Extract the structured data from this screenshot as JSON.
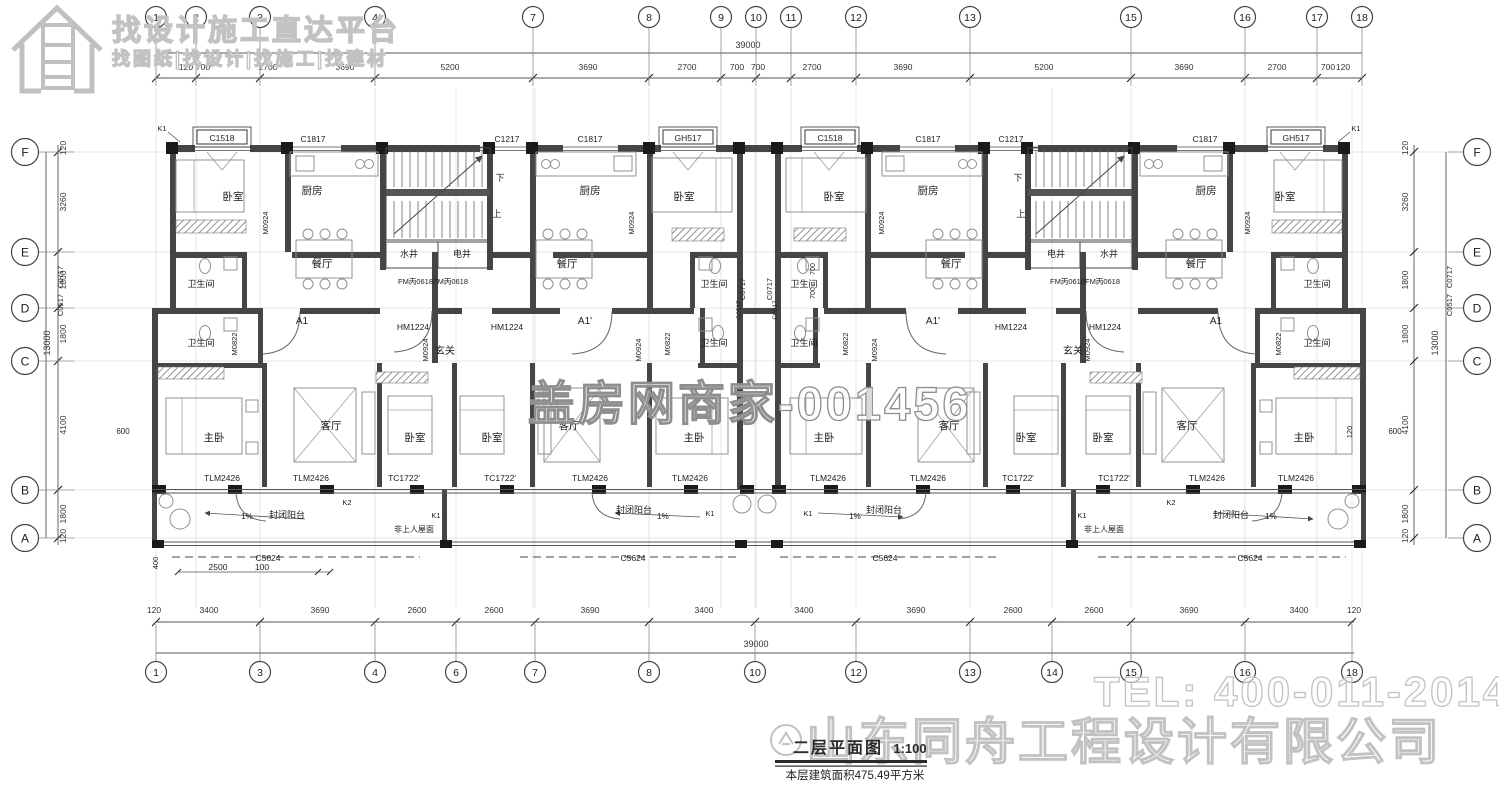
{
  "watermarks": {
    "banner_line1": "找设计施工直达平台",
    "banner_line2": "找图纸|找设计|找施工|找建材",
    "center": "盖房网商家-001456",
    "tel": "TEL: 400-011-2014",
    "company": "山东同舟工程设计有限公司"
  },
  "title_block": {
    "title": "二层平面图",
    "scale": "1:100",
    "area_note": "本层建筑面积475.49平方米"
  },
  "colors": {
    "wall": "#454545",
    "pier": "#1a1a1a",
    "dim_text": "#333333",
    "watermark": "#c2c2c2",
    "accent_line": "#555555"
  },
  "grid": {
    "total_width_label": "39000",
    "total_height_label": "13000",
    "top_bubbles": [
      {
        "label": "1",
        "x": 156
      },
      {
        "label": "2",
        "x": 196
      },
      {
        "label": "3",
        "x": 260
      },
      {
        "label": "4",
        "x": 375
      },
      {
        "label": "7",
        "x": 533
      },
      {
        "label": "8",
        "x": 649
      },
      {
        "label": "9",
        "x": 721
      },
      {
        "label": "10",
        "x": 756
      },
      {
        "label": "11",
        "x": 791
      },
      {
        "label": "12",
        "x": 856
      },
      {
        "label": "13",
        "x": 970
      },
      {
        "label": "15",
        "x": 1131
      },
      {
        "label": "16",
        "x": 1245
      },
      {
        "label": "17",
        "x": 1317
      },
      {
        "label": "18",
        "x": 1362
      }
    ],
    "bottom_bubbles": [
      {
        "label": "1",
        "x": 156
      },
      {
        "label": "3",
        "x": 260
      },
      {
        "label": "4",
        "x": 375
      },
      {
        "label": "6",
        "x": 456
      },
      {
        "label": "7",
        "x": 535
      },
      {
        "label": "8",
        "x": 649
      },
      {
        "label": "10",
        "x": 755
      },
      {
        "label": "12",
        "x": 856
      },
      {
        "label": "13",
        "x": 970
      },
      {
        "label": "14",
        "x": 1052
      },
      {
        "label": "15",
        "x": 1131
      },
      {
        "label": "16",
        "x": 1245
      },
      {
        "label": "18",
        "x": 1352
      }
    ],
    "left_bubbles": [
      {
        "label": "F",
        "y": 152
      },
      {
        "label": "E",
        "y": 252
      },
      {
        "label": "D",
        "y": 308
      },
      {
        "label": "C",
        "y": 361
      },
      {
        "label": "B",
        "y": 490
      },
      {
        "label": "A",
        "y": 538
      }
    ],
    "right_bubbles": [
      {
        "label": "F",
        "y": 152
      },
      {
        "label": "E",
        "y": 252
      },
      {
        "label": "D",
        "y": 308
      },
      {
        "label": "C",
        "y": 361
      },
      {
        "label": "B",
        "y": 490
      },
      {
        "label": "A",
        "y": 538
      }
    ],
    "top_dims": [
      {
        "t": "120",
        "x": 186
      },
      {
        "t": "700",
        "x": 203
      },
      {
        "t": "2700",
        "x": 268
      },
      {
        "t": "3690",
        "x": 345
      },
      {
        "t": "5200",
        "x": 450
      },
      {
        "t": "3690",
        "x": 588
      },
      {
        "t": "2700",
        "x": 687
      },
      {
        "t": "700",
        "x": 737
      },
      {
        "t": "700",
        "x": 758
      },
      {
        "t": "2700",
        "x": 812
      },
      {
        "t": "3690",
        "x": 903
      },
      {
        "t": "5200",
        "x": 1044
      },
      {
        "t": "3690",
        "x": 1184
      },
      {
        "t": "2700",
        "x": 1277
      },
      {
        "t": "700",
        "x": 1328
      },
      {
        "t": "120",
        "x": 1343
      }
    ],
    "bottom_dims": [
      {
        "t": "120",
        "x": 154
      },
      {
        "t": "3400",
        "x": 209
      },
      {
        "t": "3690",
        "x": 320
      },
      {
        "t": "2600",
        "x": 417
      },
      {
        "t": "2600",
        "x": 494
      },
      {
        "t": "3690",
        "x": 590
      },
      {
        "t": "3400",
        "x": 704
      },
      {
        "t": "3400",
        "x": 804
      },
      {
        "t": "3690",
        "x": 916
      },
      {
        "t": "2600",
        "x": 1013
      },
      {
        "t": "2600",
        "x": 1094
      },
      {
        "t": "3690",
        "x": 1189
      },
      {
        "t": "3400",
        "x": 1299
      },
      {
        "t": "120",
        "x": 1354
      }
    ],
    "left_dims": [
      {
        "t": "120",
        "y": 148
      },
      {
        "t": "3260",
        "y": 202
      },
      {
        "t": "1800",
        "y": 280
      },
      {
        "t": "1800",
        "y": 334
      },
      {
        "t": "4100",
        "y": 425
      },
      {
        "t": "1800",
        "y": 514
      },
      {
        "t": "120",
        "y": 536
      }
    ],
    "right_dims": [
      {
        "t": "120",
        "y": 148
      },
      {
        "t": "3260",
        "y": 202
      },
      {
        "t": "1800",
        "y": 280
      },
      {
        "t": "1800",
        "y": 334
      },
      {
        "t": "4100",
        "y": 425
      },
      {
        "t": "1800",
        "y": 514
      },
      {
        "t": "120",
        "y": 536
      }
    ]
  },
  "plan_labels": {
    "rooms": [
      {
        "t": "卧室",
        "x": 233,
        "y": 200
      },
      {
        "t": "厨房",
        "x": 312,
        "y": 194
      },
      {
        "t": "厨房",
        "x": 590,
        "y": 194
      },
      {
        "t": "卧室",
        "x": 684,
        "y": 200
      },
      {
        "t": "卧室",
        "x": 834,
        "y": 200
      },
      {
        "t": "厨房",
        "x": 928,
        "y": 194
      },
      {
        "t": "厨房",
        "x": 1206,
        "y": 194
      },
      {
        "t": "卧室",
        "x": 1285,
        "y": 200
      },
      {
        "t": "餐厅",
        "x": 322,
        "y": 267
      },
      {
        "t": "餐厅",
        "x": 567,
        "y": 267
      },
      {
        "t": "餐厅",
        "x": 951,
        "y": 267
      },
      {
        "t": "餐厅",
        "x": 1196,
        "y": 267
      },
      {
        "t": "水井",
        "x": 409,
        "y": 257,
        "s": 9
      },
      {
        "t": "电井",
        "x": 462,
        "y": 257,
        "s": 9
      },
      {
        "t": "电井",
        "x": 1056,
        "y": 257,
        "s": 9
      },
      {
        "t": "水井",
        "x": 1109,
        "y": 257,
        "s": 9
      },
      {
        "t": "卫生间",
        "x": 201,
        "y": 287,
        "s": 9
      },
      {
        "t": "卫生间",
        "x": 714,
        "y": 287,
        "s": 9
      },
      {
        "t": "卫生间",
        "x": 804,
        "y": 287,
        "s": 9
      },
      {
        "t": "卫生间",
        "x": 1317,
        "y": 287,
        "s": 9
      },
      {
        "t": "卫生间",
        "x": 201,
        "y": 346,
        "s": 9
      },
      {
        "t": "卫生间",
        "x": 714,
        "y": 346,
        "s": 9
      },
      {
        "t": "卫生间",
        "x": 804,
        "y": 346,
        "s": 9
      },
      {
        "t": "卫生间",
        "x": 1317,
        "y": 346,
        "s": 9
      },
      {
        "t": "玄关",
        "x": 445,
        "y": 354,
        "s": 10
      },
      {
        "t": "玄关",
        "x": 1073,
        "y": 354,
        "s": 10
      },
      {
        "t": "下",
        "x": 500,
        "y": 181,
        "s": 9
      },
      {
        "t": "上",
        "x": 497,
        "y": 217,
        "s": 9
      },
      {
        "t": "下",
        "x": 1018,
        "y": 181,
        "s": 9
      },
      {
        "t": "上",
        "x": 1021,
        "y": 217,
        "s": 9
      },
      {
        "t": "A1",
        "x": 302,
        "y": 324,
        "s": 10
      },
      {
        "t": "A1'",
        "x": 585,
        "y": 324,
        "s": 10
      },
      {
        "t": "A1'",
        "x": 933,
        "y": 324,
        "s": 10
      },
      {
        "t": "A1",
        "x": 1216,
        "y": 324,
        "s": 10
      },
      {
        "t": "主卧",
        "x": 214,
        "y": 441
      },
      {
        "t": "客厅",
        "x": 331,
        "y": 429
      },
      {
        "t": "卧室",
        "x": 415,
        "y": 441
      },
      {
        "t": "卧室",
        "x": 492,
        "y": 441
      },
      {
        "t": "客厅",
        "x": 569,
        "y": 429
      },
      {
        "t": "主卧",
        "x": 694,
        "y": 441
      },
      {
        "t": "主卧",
        "x": 824,
        "y": 441
      },
      {
        "t": "客厅",
        "x": 949,
        "y": 429
      },
      {
        "t": "卧室",
        "x": 1026,
        "y": 441
      },
      {
        "t": "卧室",
        "x": 1103,
        "y": 441
      },
      {
        "t": "客厅",
        "x": 1187,
        "y": 429
      },
      {
        "t": "主卧",
        "x": 1304,
        "y": 441
      },
      {
        "t": "封闭阳台",
        "x": 287,
        "y": 518,
        "s": 9
      },
      {
        "t": "封闭阳台",
        "x": 634,
        "y": 513,
        "s": 9
      },
      {
        "t": "封闭阳台",
        "x": 884,
        "y": 513,
        "s": 9
      },
      {
        "t": "封闭阳台",
        "x": 1231,
        "y": 518,
        "s": 9
      },
      {
        "t": "非上人屋面",
        "x": 414,
        "y": 532,
        "s": 8
      },
      {
        "t": "非上人屋面",
        "x": 1104,
        "y": 532,
        "s": 8
      }
    ],
    "tags": [
      {
        "t": "C1518",
        "x": 222,
        "y": 139,
        "box": true
      },
      {
        "t": "GH517",
        "x": 688,
        "y": 139,
        "box": true
      },
      {
        "t": "C1518",
        "x": 830,
        "y": 139,
        "box": true
      },
      {
        "t": "GH517",
        "x": 1296,
        "y": 139,
        "box": true
      },
      {
        "t": "C1817",
        "x": 313,
        "y": 140
      },
      {
        "t": "C1217",
        "x": 507,
        "y": 140
      },
      {
        "t": "C1817",
        "x": 590,
        "y": 140
      },
      {
        "t": "C1817",
        "x": 928,
        "y": 140
      },
      {
        "t": "C1217",
        "x": 1011,
        "y": 140
      },
      {
        "t": "C1817",
        "x": 1205,
        "y": 140
      },
      {
        "t": "FM丙0618FM丙0618",
        "x": 433,
        "y": 282,
        "s": 7.5
      },
      {
        "t": "FM丙0618FM丙0618",
        "x": 1085,
        "y": 282,
        "s": 7.5
      },
      {
        "t": "HM1224",
        "x": 413,
        "y": 328
      },
      {
        "t": "HM1224",
        "x": 507,
        "y": 328
      },
      {
        "t": "HM1224",
        "x": 1011,
        "y": 328
      },
      {
        "t": "HM1224",
        "x": 1105,
        "y": 328
      },
      {
        "t": "TLM2426",
        "x": 222,
        "y": 479
      },
      {
        "t": "TLM2426",
        "x": 311,
        "y": 479
      },
      {
        "t": "TC1722'",
        "x": 404,
        "y": 479
      },
      {
        "t": "TC1722'",
        "x": 500,
        "y": 479
      },
      {
        "t": "TLM2426",
        "x": 590,
        "y": 479
      },
      {
        "t": "TLM2426",
        "x": 690,
        "y": 479
      },
      {
        "t": "TLM2426",
        "x": 828,
        "y": 479
      },
      {
        "t": "TLM2426",
        "x": 928,
        "y": 479
      },
      {
        "t": "TC1722'",
        "x": 1018,
        "y": 479
      },
      {
        "t": "TC1722'",
        "x": 1114,
        "y": 479
      },
      {
        "t": "TLM2426",
        "x": 1207,
        "y": 479
      },
      {
        "t": "TLM2426",
        "x": 1296,
        "y": 479
      },
      {
        "t": "C5624",
        "x": 268,
        "y": 559
      },
      {
        "t": "C5624",
        "x": 633,
        "y": 559
      },
      {
        "t": "C5624",
        "x": 885,
        "y": 559
      },
      {
        "t": "C5624",
        "x": 1250,
        "y": 559
      },
      {
        "t": "K1",
        "x": 162,
        "y": 129,
        "s": 7.5
      },
      {
        "t": "K1",
        "x": 1356,
        "y": 129,
        "s": 7.5
      },
      {
        "t": "K1",
        "x": 436,
        "y": 516,
        "s": 7.5
      },
      {
        "t": "K1",
        "x": 710,
        "y": 514,
        "s": 7.5
      },
      {
        "t": "K1",
        "x": 808,
        "y": 514,
        "s": 7.5
      },
      {
        "t": "K1",
        "x": 1082,
        "y": 516,
        "s": 7.5
      },
      {
        "t": "K2",
        "x": 347,
        "y": 503,
        "s": 7.5
      },
      {
        "t": "K2",
        "x": 1171,
        "y": 503,
        "s": 7.5
      },
      {
        "t": "1%",
        "x": 247,
        "y": 517,
        "s": 8
      },
      {
        "t": "1%",
        "x": 663,
        "y": 517,
        "s": 8
      },
      {
        "t": "1%",
        "x": 855,
        "y": 517,
        "s": 8
      },
      {
        "t": "1%",
        "x": 1271,
        "y": 517,
        "s": 8
      },
      {
        "t": "600",
        "x": 123,
        "y": 432,
        "s": 8
      },
      {
        "t": "600",
        "x": 1395,
        "y": 432,
        "s": 8
      },
      {
        "t": "2500",
        "x": 218,
        "y": 568,
        "s": 8.5
      },
      {
        "t": "100",
        "x": 262,
        "y": 568,
        "s": 8.5
      }
    ],
    "vtags": [
      {
        "t": "C0717",
        "x": 63,
        "y": 277
      },
      {
        "t": "C0517",
        "x": 63,
        "y": 305
      },
      {
        "t": "C0717",
        "x": 1452,
        "y": 277
      },
      {
        "t": "C0517",
        "x": 1452,
        "y": 305
      },
      {
        "t": "C0717",
        "x": 745,
        "y": 289
      },
      {
        "t": "C0717",
        "x": 772,
        "y": 289
      },
      {
        "t": "C0517",
        "x": 741,
        "y": 310,
        "s": 6.5
      },
      {
        "t": "C0517",
        "x": 777,
        "y": 310,
        "s": 6.5
      },
      {
        "t": "M0924",
        "x": 268,
        "y": 223
      },
      {
        "t": "M0924",
        "x": 634,
        "y": 223
      },
      {
        "t": "M0924",
        "x": 884,
        "y": 223
      },
      {
        "t": "M0924",
        "x": 1250,
        "y": 223
      },
      {
        "t": "M0924",
        "x": 428,
        "y": 350
      },
      {
        "t": "M0924",
        "x": 641,
        "y": 350
      },
      {
        "t": "M0924",
        "x": 877,
        "y": 350
      },
      {
        "t": "M0924",
        "x": 1090,
        "y": 350
      },
      {
        "t": "M0822",
        "x": 237,
        "y": 344
      },
      {
        "t": "M0822",
        "x": 670,
        "y": 344
      },
      {
        "t": "M0822",
        "x": 848,
        "y": 344
      },
      {
        "t": "M0822",
        "x": 1281,
        "y": 344
      },
      {
        "t": "700",
        "x": 815,
        "y": 269,
        "s": 7
      },
      {
        "t": "700",
        "x": 815,
        "y": 293,
        "s": 7
      },
      {
        "t": "400",
        "x": 158,
        "y": 563,
        "s": 7.5
      },
      {
        "t": "120",
        "x": 1352,
        "y": 432,
        "s": 7.5
      }
    ]
  }
}
